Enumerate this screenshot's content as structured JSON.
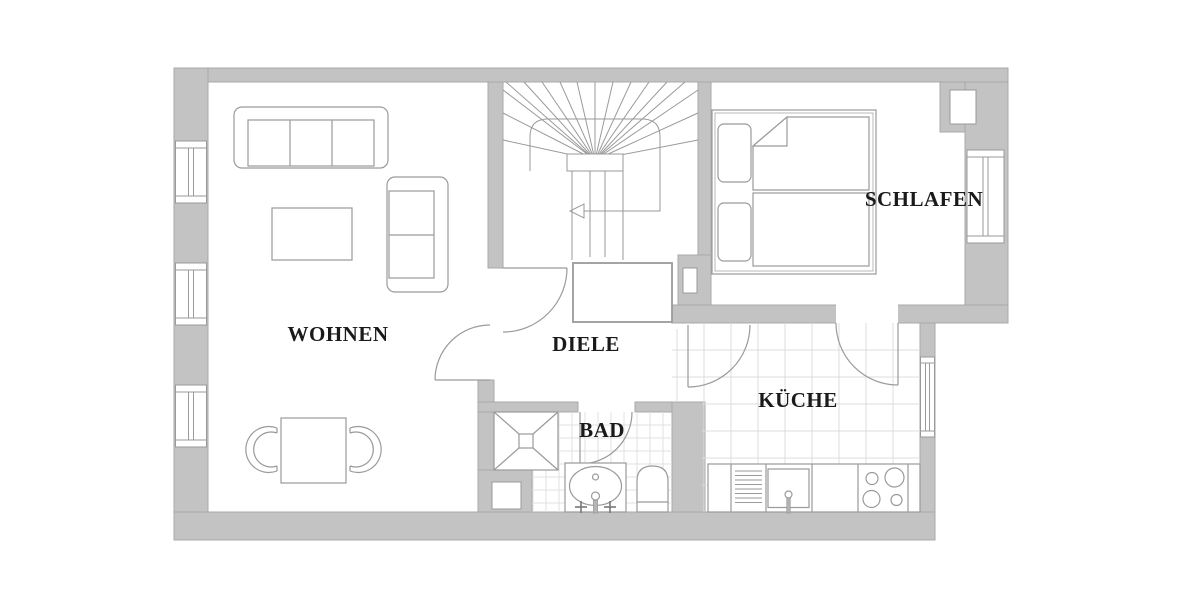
{
  "document": {
    "type": "apartment-floor-plan",
    "floor_label": ""
  },
  "rooms": [
    {
      "id": "wohnen",
      "label": "WOHNEN"
    },
    {
      "id": "diele",
      "label": "DIELE"
    },
    {
      "id": "schlafen",
      "label": "SCHLAFEN"
    },
    {
      "id": "bad",
      "label": "BAD"
    },
    {
      "id": "kueche",
      "label": "KÜCHE"
    }
  ],
  "fixtures": [
    "sofa-3-seat",
    "sofa-2-seat",
    "coffee-table",
    "dining-table",
    "chair",
    "chair",
    "double-bed",
    "pillow",
    "pillow",
    "mattress-folded",
    "mattress",
    "hall-cabinet",
    "winder-staircase",
    "stair-walk-line",
    "stair-direction-arrow",
    "shower",
    "washbasin-vanity",
    "toilet",
    "kitchen-counter",
    "drainboard",
    "kitchen-sink",
    "stove-4-burners",
    "window",
    "window",
    "window",
    "window",
    "window",
    "door-swing",
    "door-swing",
    "door-swing",
    "door-swing",
    "door-swing"
  ],
  "colors": {
    "wall": "#c3c3c3",
    "wall_edge": "#a8a8a8",
    "line": "#9a9a9a",
    "tile": "#dcdcdc",
    "label": "#1a1a1a",
    "background": "#ffffff"
  }
}
